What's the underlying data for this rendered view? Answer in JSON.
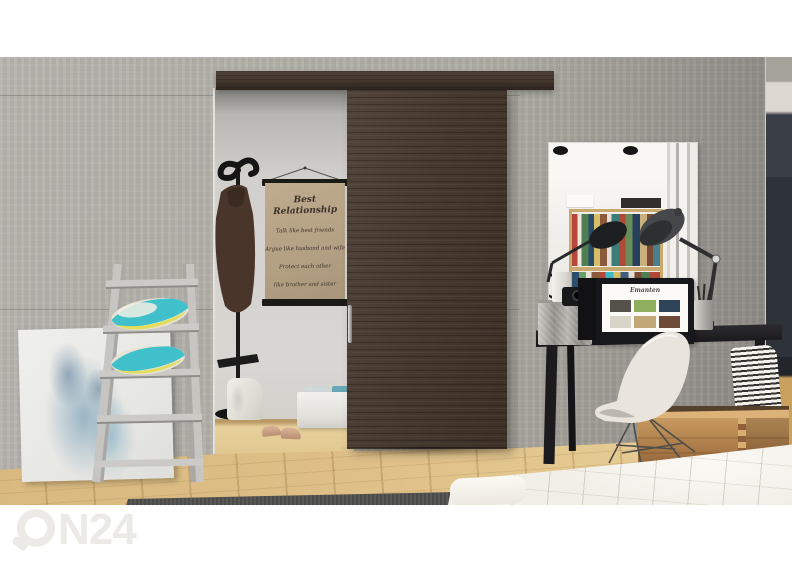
{
  "watermark": {
    "brand": "ON24",
    "suffix": "N24"
  },
  "poster": {
    "title": "Best Relationship",
    "lines": [
      "Talk like best friends",
      "Argue like husband and wife",
      "Protect each other",
      "like brother and sister"
    ]
  },
  "laptop": {
    "logo": "Emanten"
  },
  "colors": {
    "wall": "#adaaa3",
    "alcove_wall": "#d2d0cc",
    "door": "#46392f",
    "rail": "#40342b",
    "floor": "#debf87",
    "rug": "#4b4b49",
    "desk": "#222226",
    "mirror": "#f1efeb",
    "bed": "#f2efe9",
    "crate": "#aa7a48",
    "chair": "#e9e5dd",
    "pillow_teal": "#3fc0cb",
    "pillow_yellow": "#e2dd5c",
    "canvas_blue": "#7fb0c9",
    "hallway": "#2e3239",
    "watermark": "#ebeae7"
  }
}
